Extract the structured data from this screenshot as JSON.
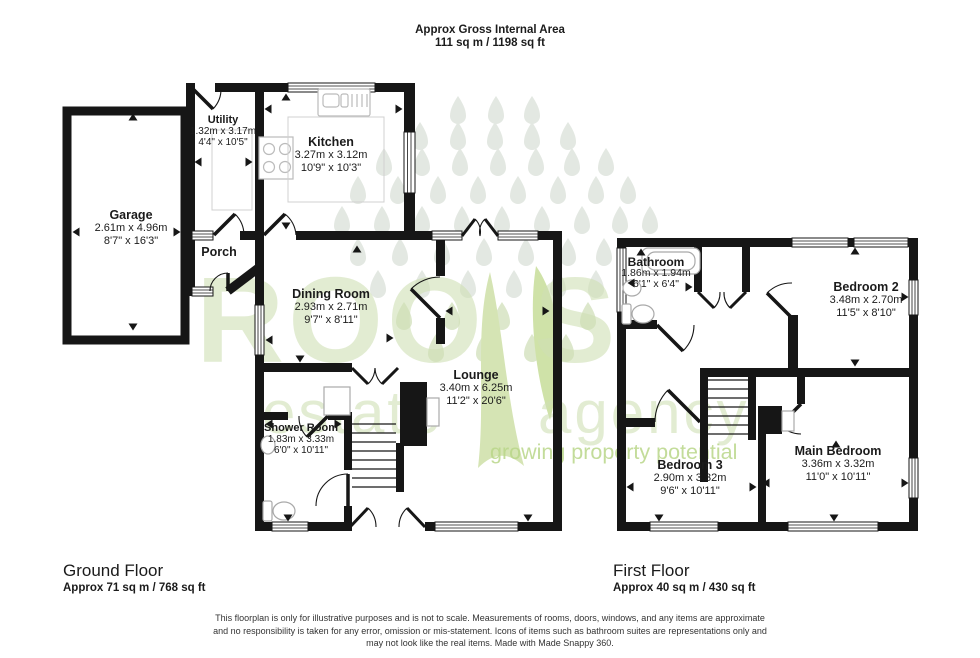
{
  "header": {
    "title": "Approx Gross Internal Area",
    "subtitle": "111 sq m / 1198 sq ft"
  },
  "watermark": {
    "brand_left": "ROO",
    "brand_right": "S",
    "sub_left": "estate",
    "sub_right": "agency",
    "tagline": "growing property potential",
    "brand_color": "#cfe0b4",
    "tagline_color": "#b9d688"
  },
  "colors": {
    "wall": "#161616",
    "fixture_outline": "#a9a9a9"
  },
  "ground_floor": {
    "label": "Ground Floor",
    "area": "Approx 71 sq m / 768 sq ft",
    "rooms": [
      {
        "name": "Garage",
        "metric": "2.61m x 4.96m",
        "imperial": "8'7\" x 16'3\""
      },
      {
        "name": "Utility",
        "metric": "1.32m x 3.17m",
        "imperial": "4'4\" x 10'5\""
      },
      {
        "name": "Kitchen",
        "metric": "3.27m x 3.12m",
        "imperial": "10'9\" x 10'3\""
      },
      {
        "name": "Porch",
        "metric": "",
        "imperial": ""
      },
      {
        "name": "Dining Room",
        "metric": "2.93m x 2.71m",
        "imperial": "9'7\" x 8'11\""
      },
      {
        "name": "Lounge",
        "metric": "3.40m x 6.25m",
        "imperial": "11'2\" x 20'6\""
      },
      {
        "name": "Shower Room",
        "metric": "1.83m x 3.33m",
        "imperial": "6'0\" x 10'11\""
      }
    ]
  },
  "first_floor": {
    "label": "First Floor",
    "area": "Approx 40 sq m / 430 sq ft",
    "rooms": [
      {
        "name": "Bathroom",
        "metric": "1.86m x 1.94m",
        "imperial": "6'1\" x 6'4\""
      },
      {
        "name": "Bedroom 2",
        "metric": "3.48m x 2.70m",
        "imperial": "11'5\" x 8'10\""
      },
      {
        "name": "Bedroom 3",
        "metric": "2.90m x 3.32m",
        "imperial": "9'6\" x 10'11\""
      },
      {
        "name": "Main Bedroom",
        "metric": "3.36m x 3.32m",
        "imperial": "11'0\" x 10'11\""
      }
    ]
  },
  "disclaimer": {
    "lines": [
      "This floorplan is only for illustrative purposes and is not to scale. Measurements of rooms, doors, windows, and any items are approximate",
      "and no responsibility is taken for any error, omission or mis-statement. Icons of items such as bathroom suites are representations only and",
      "may not look like the real items. Made with Made Snappy 360."
    ]
  }
}
